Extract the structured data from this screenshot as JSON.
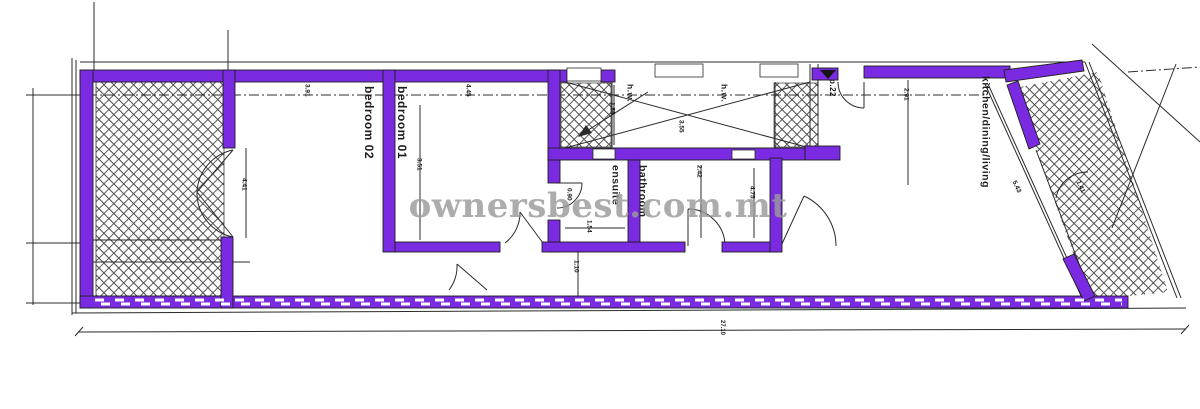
{
  "watermark": {
    "text": "ownersbest.com.mt"
  },
  "colors": {
    "wall": "#7a2be2",
    "line": "#2b2b2b",
    "hatch": "#4a4a4a",
    "watermark": "#9a9a9a",
    "paper": "#ffffff"
  },
  "rooms": {
    "bedroom02": "bedroom 02",
    "bedroom01": "bedroom 01",
    "ensuite": "ensuite",
    "bathroom": "bathroom",
    "kitchen": "kitchen/dining/living",
    "hw_left": "h.w.",
    "hw_right": "h.w."
  },
  "annotations": {
    "door_ref": "p.22"
  },
  "dimensions": {
    "bedroom02_width": "3.91",
    "bedroom02_height": "4.41",
    "bedroom01_width": "4.45",
    "bedroom01_height": "3.51",
    "shaft_left": "1.55",
    "shaft_width": "3.55",
    "ensuite_door": "0.90",
    "ensuite_width": "1.54",
    "bathroom_depth": "2.42",
    "hall_depth": "4.75",
    "corridor_width": "1.10",
    "kitchen_top": "2.91",
    "kitchen_glass": "5.43",
    "terrace_right": "1.41",
    "overall_length": "27.10"
  }
}
